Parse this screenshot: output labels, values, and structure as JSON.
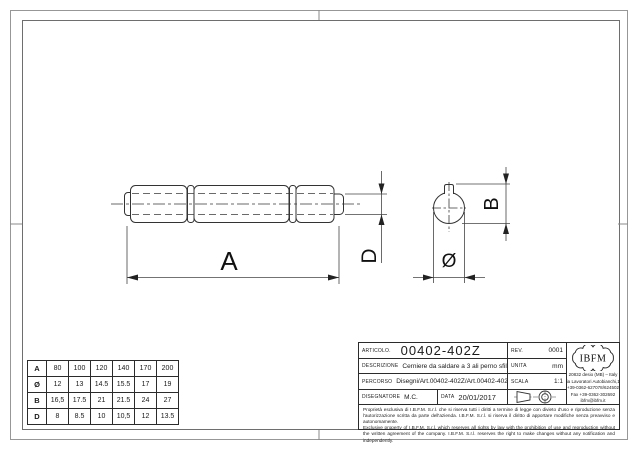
{
  "drawing": {
    "dim_length_label": "A",
    "dim_pin_label": "D",
    "dim_height_label": "B",
    "dim_diameter_label": "Ø"
  },
  "size_table": {
    "rows": [
      {
        "label": "A",
        "values": [
          "80",
          "100",
          "120",
          "140",
          "170",
          "200"
        ]
      },
      {
        "label": "Ø",
        "values": [
          "12",
          "13",
          "14.5",
          "15.5",
          "17",
          "19"
        ]
      },
      {
        "label": "B",
        "values": [
          "16,5",
          "17.5",
          "21",
          "21.5",
          "24",
          "27"
        ]
      },
      {
        "label": "D",
        "values": [
          "8",
          "8.5",
          "10",
          "10,5",
          "12",
          "13.5"
        ]
      }
    ]
  },
  "title_block": {
    "articolo_label": "ARTICOLO.",
    "articolo_value": "00402-402Z",
    "rev_label": "REV.",
    "rev_value": "0001",
    "descrizione_label": "DESCRIZIONE",
    "descrizione_value": "Cerniere da saldare a 3 ali perno sfilabile",
    "unita_label": "UNITA",
    "unita_value": "mm",
    "percorso_label": "PERCORSO",
    "percorso_value": "Disegni/Art.00402-402Z/Art.00402-402Z.dwg",
    "scala_label": "SCALA",
    "scala_value": "1:1",
    "disegnatore_label": "DISEGNATORE",
    "disegnatore_value": "M.C.",
    "data_label": "DATA",
    "data_value": "20/01/2017",
    "logo_text": "IBFM",
    "address_lines": [
      "20832 desio (MB) – Italy",
      "Via Lavoratori Autobianchi,18",
      "+39-0362-627078/624502",
      "Fax +39-0362-302692",
      "ibfm@ibfm.it"
    ],
    "legal_it": "Proprietà esclusiva di I.B.F.M. S.r.l. che si riserva tutti i diritti a termine di legge con divieto d'uso e riproduzione senza l'autorizzazione scritta da parte dell'azienda. I.B.F.M. S.r.l. si riserva il diritto di apportare modifiche senza preavviso e autonomamente.",
    "legal_en": "Exclusive property of I.B.F.M. S.r.l. which reserves all rights by law with the prohibition of use and reproduction without the written agreement of the company. I.B.F.M. S.r.l. reserves the right to make changes without any notification and independently."
  }
}
